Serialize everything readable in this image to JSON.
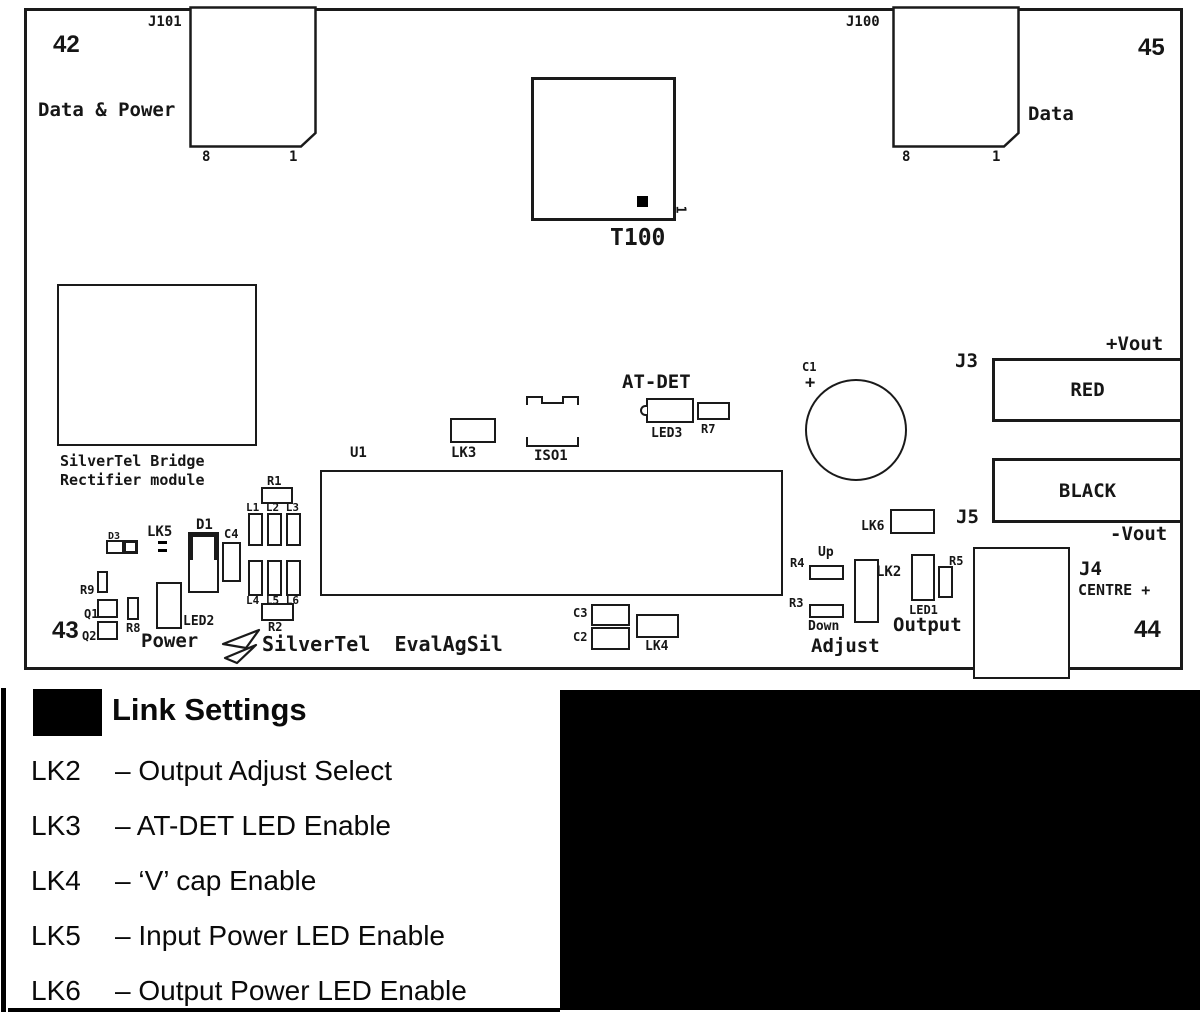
{
  "board": {
    "corners": {
      "top_left": "42",
      "top_right": "45",
      "bottom_left": "43",
      "bottom_right": "44"
    },
    "connectors": {
      "j101": {
        "ref": "J101",
        "caption": "Data & Power",
        "pin_left": "8",
        "pin_right": "1"
      },
      "j100": {
        "ref": "J100",
        "caption": "Data",
        "pin_left": "8",
        "pin_right": "1"
      },
      "t100": {
        "ref": "T100",
        "pin1": "1"
      },
      "j3": {
        "ref": "J3",
        "label": "RED",
        "rail": "+Vout"
      },
      "j5": {
        "ref": "J5",
        "label": "BLACK",
        "rail": "-Vout"
      },
      "j4": {
        "ref": "J4",
        "caption": "CENTRE +"
      }
    },
    "module": {
      "line1": "SilverTel Bridge",
      "line2": "Rectifier module"
    },
    "brand": "SilverTel  EvalAgSil",
    "groups": {
      "at_det": "AT-DET",
      "power": "Power",
      "output": "Output",
      "adjust": "Adjust",
      "up": "Up",
      "down": "Down"
    },
    "silk": {
      "u1": "U1",
      "lk3": "LK3",
      "iso1": "ISO1",
      "led3": "LED3",
      "r7": "R7",
      "c1": "C1",
      "c1_polarity": "+",
      "lk6": "LK6",
      "r1": "R1",
      "l_top": "L1 L2 L3",
      "l_bottom": "L4 L5 L6",
      "r2": "R2",
      "d3": "D3",
      "lk5": "LK5",
      "d1": "D1",
      "c4": "C4",
      "r9": "R9",
      "q1": "Q1",
      "q2": "Q2",
      "r8": "R8",
      "led2": "LED2",
      "c3": "C3",
      "c2": "C2",
      "lk4": "LK4",
      "r4": "R4",
      "r3": "R3",
      "lk2": "LK2",
      "led1": "LED1",
      "r5": "R5"
    }
  },
  "legend": {
    "title": "Link Settings",
    "items": [
      {
        "ref": "LK2",
        "desc": "– Output Adjust Select"
      },
      {
        "ref": "LK3",
        "desc": "– AT-DET LED Enable"
      },
      {
        "ref": "LK4",
        "desc": "– ‘V’ cap Enable"
      },
      {
        "ref": "LK5",
        "desc": "– Input Power LED Enable"
      },
      {
        "ref": "LK6",
        "desc": "– Output Power LED Enable"
      }
    ]
  }
}
